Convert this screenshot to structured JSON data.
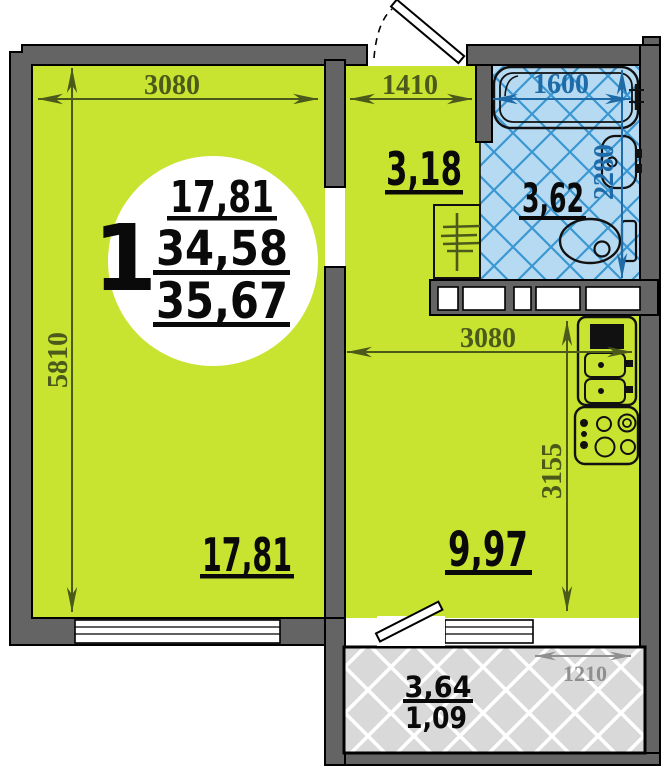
{
  "plan": {
    "unit_circle": {
      "flat_number": "1",
      "living_area": "17,81",
      "area_sub": "34,58",
      "area_total": "35,67"
    },
    "rooms": {
      "living": {
        "area": "17,81"
      },
      "hallway": {
        "area": "3,18"
      },
      "bathroom": {
        "area": "3,62"
      },
      "kitchen": {
        "area": "9,97"
      },
      "balcony": {
        "area": "3,64",
        "area_coef": "1,09"
      }
    },
    "dimensions_mm": {
      "living_width": "3080",
      "living_depth": "5810",
      "hallway_width": "1410",
      "bathroom_width": "1600",
      "bathroom_depth": "2280",
      "kitchen_width": "3080",
      "kitchen_depth": "3155",
      "balcony_width": "1210"
    },
    "colors": {
      "room_fill": "#c8e430",
      "wall_fill": "#646464",
      "bathroom_fill": "#b5daf2",
      "bathroom_grid": "#3a97d2",
      "balcony_fill": "#d9d9d9",
      "dim_olive": "#4b5a1b",
      "dim_blue": "#1e6ba8",
      "dim_gray": "#8f8f8f"
    }
  }
}
